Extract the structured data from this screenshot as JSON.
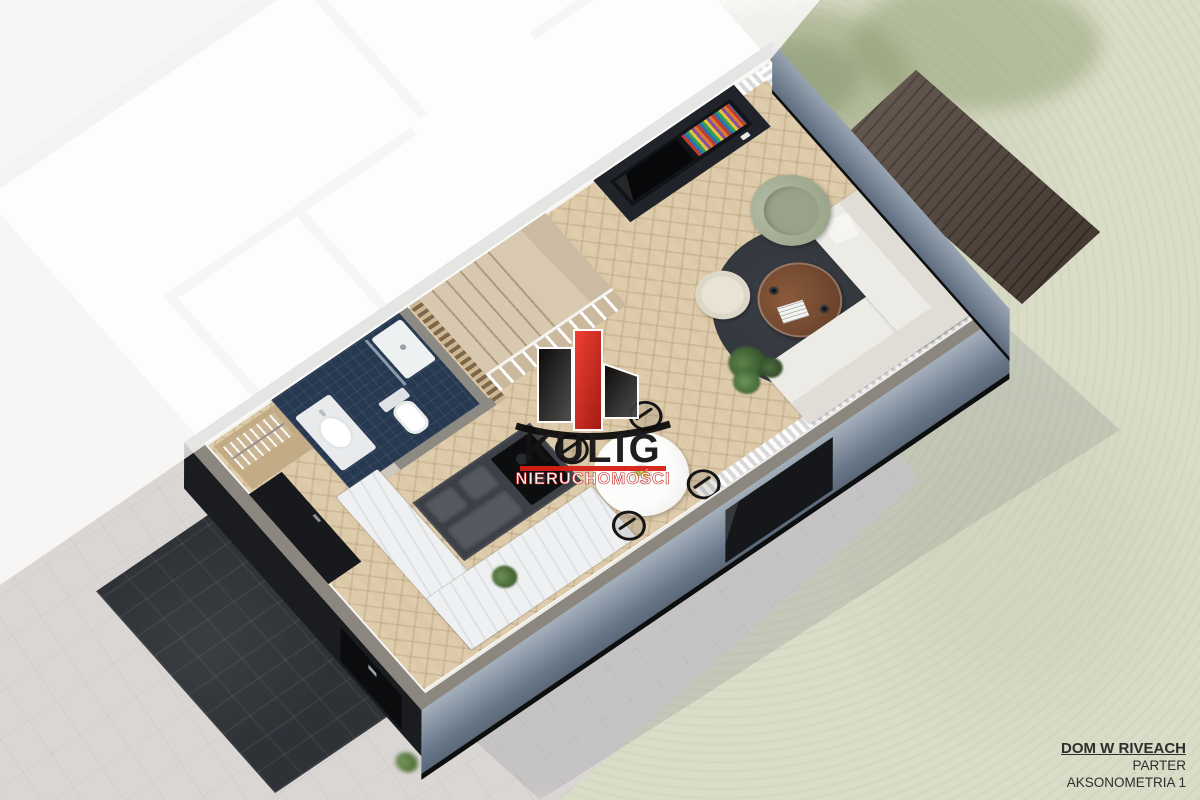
{
  "watermark": {
    "brand": "KULIG",
    "tagline": "NIERUCHOMOŚCI",
    "accent_red": "#d81f17"
  },
  "title_block": {
    "project": "DOM W RIVEACH",
    "floor": "PARTER",
    "view": "AKSONOMETRIA 1"
  },
  "palette": {
    "pavement_gray": "#d9d6d3",
    "grass_green": "#d9dcc6",
    "deck_wood_dark": "#41352e",
    "wall_cap_gray": "#8b877f",
    "wall_face_blue": "#69788a",
    "floor_oak": "#dcc9a8",
    "bathroom_navy": "#273950",
    "island_charcoal": "#3d4147",
    "counter_marble": "#eef0f1",
    "armchair_sage": "#a9b39a",
    "rug_charcoal": "#3a3e45",
    "coffee_table_wood": "#7b4f33",
    "sofa_white": "#ecebe6",
    "entry_pad_dark": "#2e3237",
    "logo_red": "#d81f17",
    "logo_black": "#141414"
  }
}
